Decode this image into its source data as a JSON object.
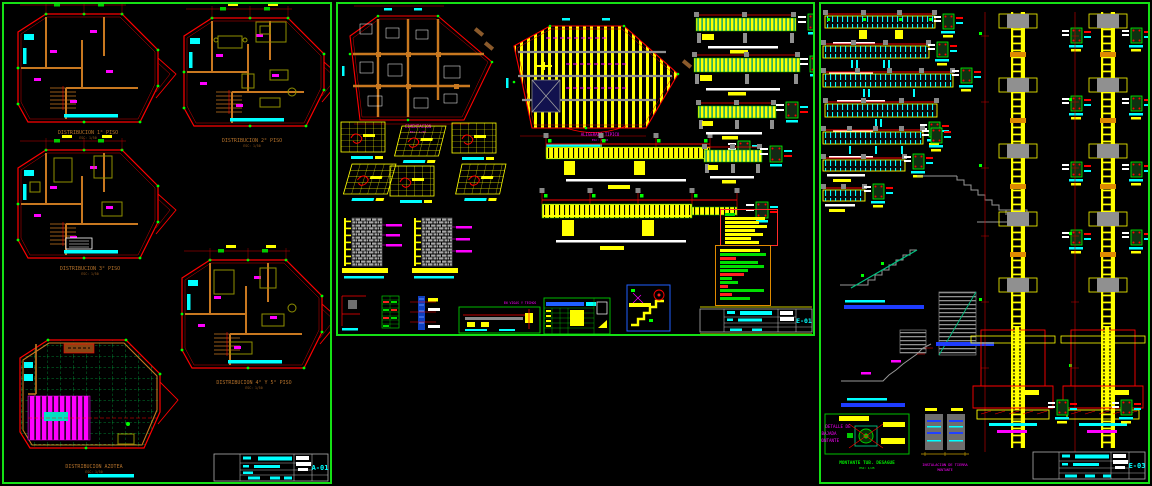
{
  "app": {
    "description": "CAD drawing set - three plan sheets on black model space",
    "background": "#000000",
    "sheet_border_color": "#15E015"
  },
  "palette": {
    "red": "#FF0000",
    "orange_wall": "#C87820",
    "yellow": "#FFFF00",
    "green": "#00FF00",
    "teal": "#00B880",
    "cyan": "#00FFFF",
    "magenta": "#FF00FF",
    "gray": "#909090",
    "white": "#FFFFFF",
    "blue": "#2040FF",
    "title_text": "#B5722B"
  },
  "sheet_left": {
    "discipline": "ARQUITECTURA",
    "plans": [
      {
        "title": "DISTRIBUCION 1° PISO",
        "scale": "ESC: 1/50"
      },
      {
        "title": "DISTRIBUCION 2° PISO",
        "scale": "ESC: 1/50"
      },
      {
        "title": "DISTRIBUCION 3° PISO",
        "scale": "ESC: 1/50"
      },
      {
        "title": "DISTRIBUCION 4° Y 5° PISO",
        "scale": "ESC: 1/50"
      },
      {
        "title": "DISTRIBUCION AZOTEA",
        "scale": "ESC: 1/50"
      }
    ],
    "title_block": {
      "sheet_no": "A-01"
    }
  },
  "sheet_mid": {
    "discipline": "ESTRUCTURAS",
    "plan_a": {
      "title": "CIMENTACION",
      "scale": "ESC: 1/50"
    },
    "plan_b": {
      "title": "ALIGERADO TIPICO",
      "scale": "ESC: 1/50"
    },
    "doblez_label_1": "DOBLADURAS TIPICAS ACERO",
    "doblez_label_2": "EN VIGAS Y TECHOS",
    "title_block": {
      "sheet_no": "E-01"
    },
    "notes_bars": [
      {
        "w": 10,
        "c": "#00DD00"
      },
      {
        "w": 40,
        "c": "#FFFF00"
      },
      {
        "w": 34,
        "c": "#FFFF00"
      },
      {
        "w": 42,
        "c": "#FFFF00"
      },
      {
        "w": 30,
        "c": "#FFFF00"
      },
      {
        "w": 38,
        "c": "#FFFF00"
      },
      {
        "w": 26,
        "c": "#FFFF00"
      },
      {
        "w": 34,
        "c": "#FFFF00"
      }
    ],
    "legend_bars": [
      {
        "w": 40,
        "c": "#FFFF00"
      },
      {
        "w": 46,
        "c": "#00DD00"
      },
      {
        "w": 16,
        "c": "#FF2020"
      },
      {
        "w": 38,
        "c": "#00DD00"
      },
      {
        "w": 44,
        "c": "#00DD00"
      },
      {
        "w": 28,
        "c": "#00DD00"
      },
      {
        "w": 24,
        "c": "#FF2020"
      },
      {
        "w": 12,
        "c": "#00DD00"
      },
      {
        "w": 18,
        "c": "#00DD00"
      },
      {
        "w": 8,
        "c": "#FF2020"
      },
      {
        "w": 44,
        "c": "#00DD00"
      },
      {
        "w": 12,
        "c": "#FF2020"
      },
      {
        "w": 30,
        "c": "#00DD00"
      }
    ]
  },
  "sheet_right": {
    "discipline": "ESTRUCTURAS",
    "bajada_box": {
      "line1": "DETALLE DE",
      "line2": "BAJADA",
      "line3": "MONTANTE"
    },
    "montante_label_1": "MONTANTE TUB. DESAGUE",
    "montante_label_2": "ESC: 1/25",
    "tierra_label_1": "INSTALACION DE TIERRA",
    "tierra_label_2": "MONTANTE",
    "title_block": {
      "sheet_no": "E-03"
    }
  }
}
